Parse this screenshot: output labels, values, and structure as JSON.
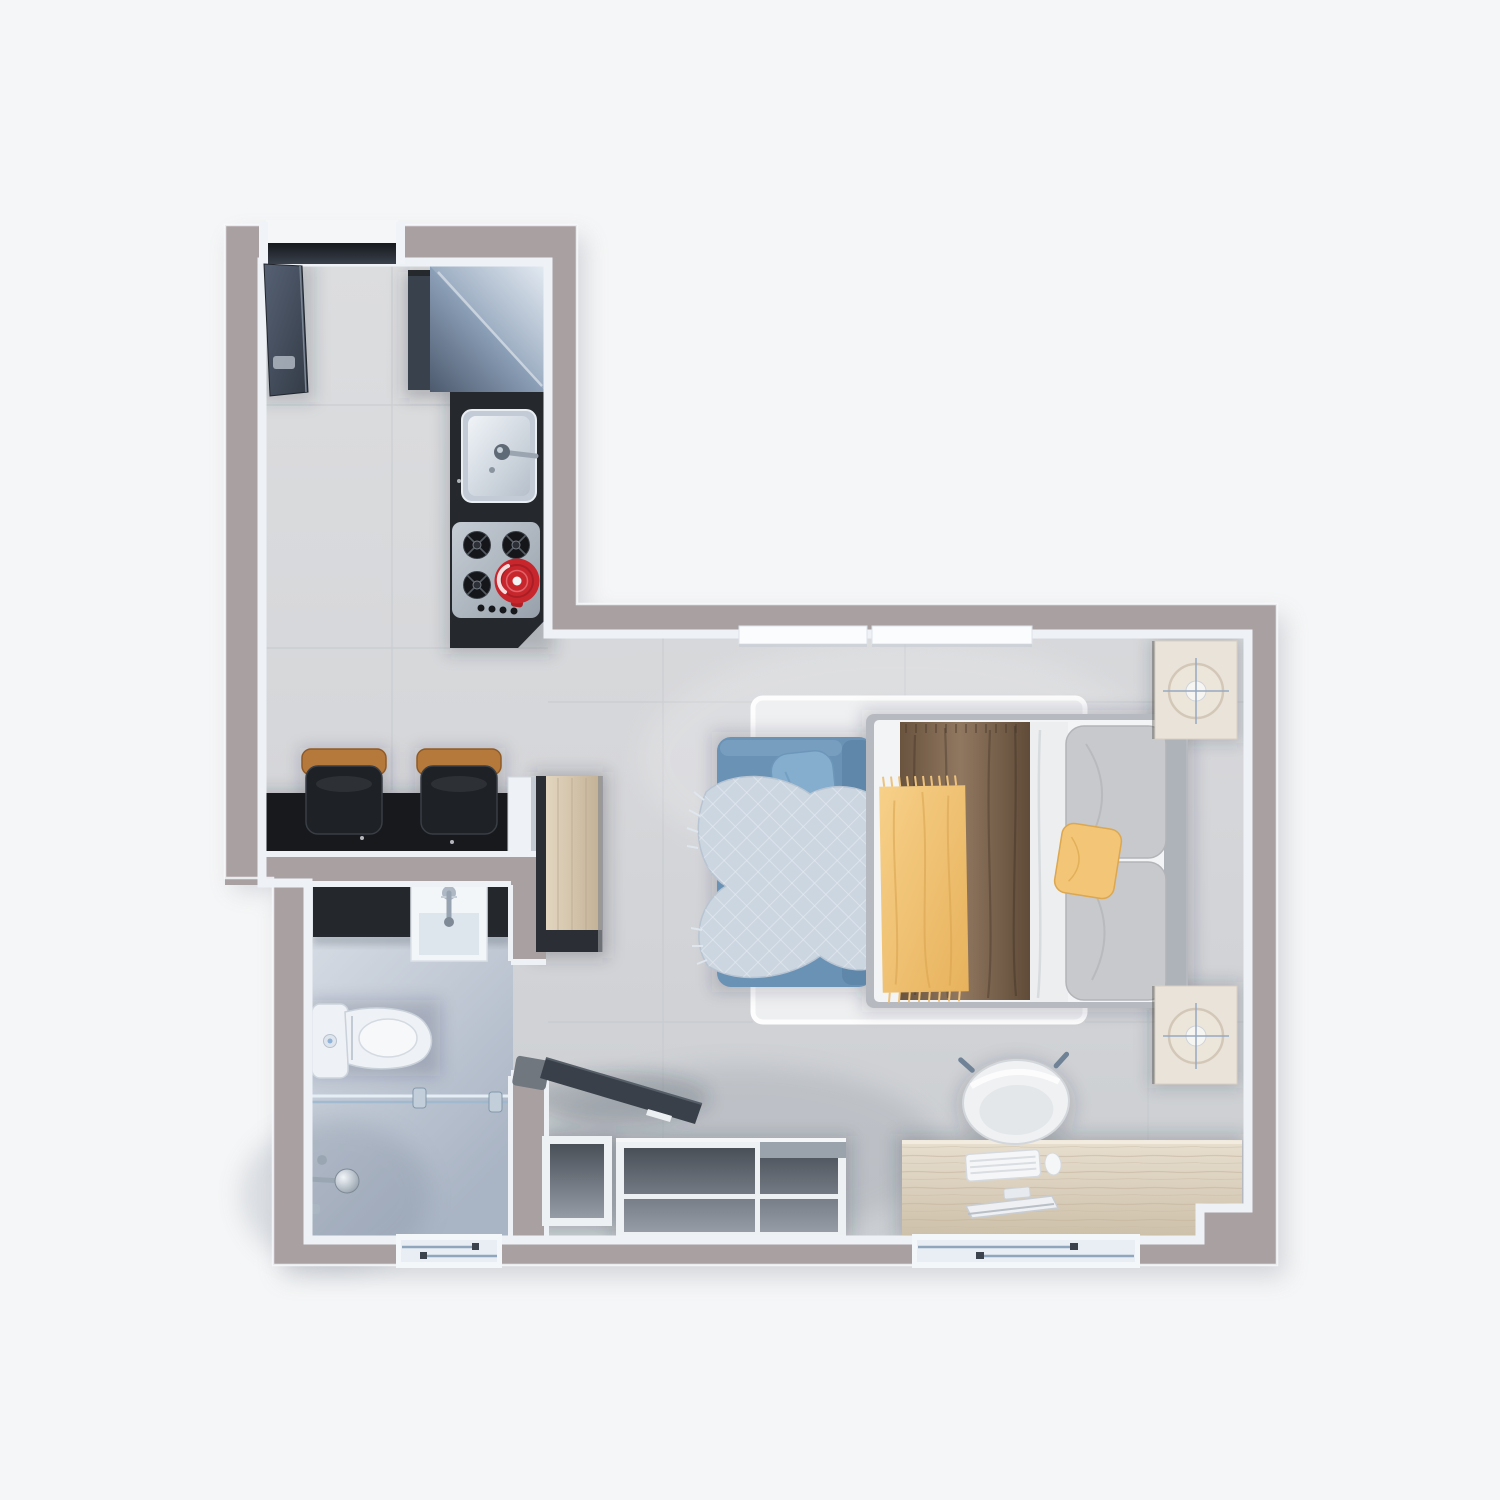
{
  "scene": {
    "kind": "3d-floorplan-top-view",
    "rooms": [
      {
        "id": "kitchen-hall",
        "contents": [
          "entry-door",
          "refrigerator",
          "kitchen-counter",
          "kitchen-sink",
          "gas-stove",
          "red-pot",
          "breakfast-bar",
          "bar-stool",
          "bar-stool"
        ]
      },
      {
        "id": "bathroom",
        "contents": [
          "vanity",
          "vanity-sink",
          "toilet",
          "shower-screen",
          "shower-fixtures",
          "window"
        ]
      },
      {
        "id": "studio-room",
        "contents": [
          "wardrobe",
          "sofa",
          "sofa-pillow",
          "plaid-throw",
          "rug",
          "double-bed",
          "duvet",
          "yellow-throw",
          "pillows",
          "accent-pillow",
          "nightstand-lamp",
          "nightstand-lamp",
          "desk",
          "office-chair",
          "keyboard",
          "mouse",
          "monitor",
          "tv",
          "tv-console",
          "clerestory-window",
          "clerestory-window",
          "window"
        ]
      }
    ]
  },
  "palette": {
    "exterior": "#f5f6f7",
    "wall": "#a9a0a2",
    "lining": "#eef2f7",
    "floor": "#d8d9db",
    "bathFloor": "#c7cfda",
    "counterBar": "#17191d",
    "counterKitchen": "#25282d",
    "stoolWood": "#b5793c",
    "stoolSeat": "#1e2126",
    "fridgeDark": "#39414c",
    "steel": "#aeb7c1",
    "burner": "#14161a",
    "kettleRed": "#c8262d",
    "wardrobeEdge": "#2b2f35",
    "porcelain": "#eef1f5",
    "glass": "#9fb8cf",
    "chrome": "#9aa7b3",
    "vanityDark": "#24272c",
    "rug": "#f0f1f2",
    "sofa": "#6a92b5",
    "sofaPillow": "#84adce",
    "throwPlaid": "#ccd6e1",
    "bedFrame": "#b6bac0",
    "mattress": "#f2f4f6",
    "duvetBrown": "#7d664f",
    "sheet": "#eceef0",
    "pillowGray": "#c7c9cc",
    "accentYellow": "#f3c577",
    "nightstand": "#eae3d9",
    "deskWood": "#ded4c2",
    "consoleFrame": "#eef1f4",
    "consoleInner": "#646b76",
    "tv": "#3a4049",
    "chair": "#eff1f3",
    "doorLeaf": "#3f4855",
    "shadow": "#2a3440"
  }
}
